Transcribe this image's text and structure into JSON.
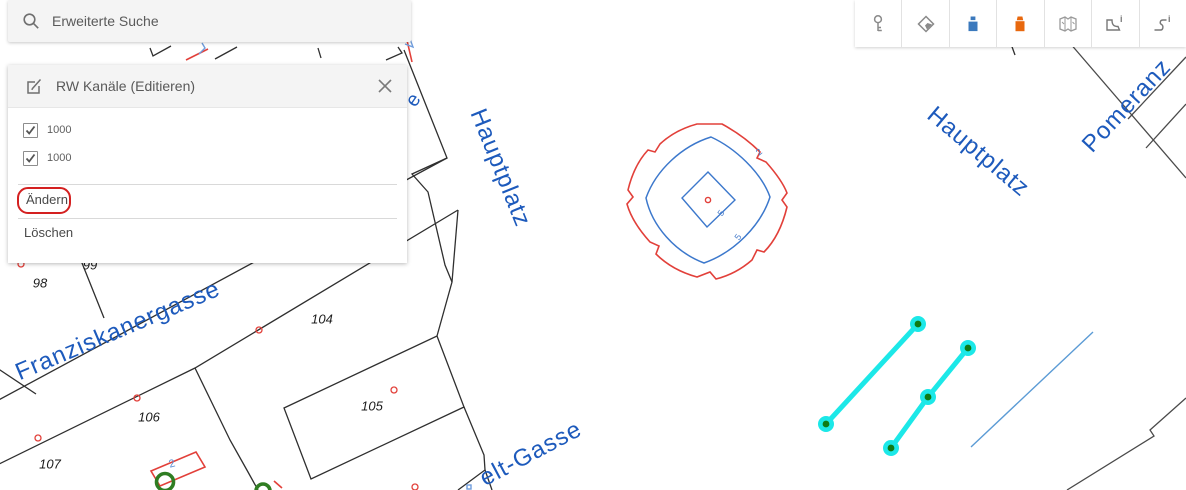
{
  "search": {
    "placeholder": "Erweiterte Suche"
  },
  "edit_panel": {
    "title": "RW Kanäle (Editieren)",
    "items": [
      {
        "type": "checkbox",
        "label": "1000",
        "checked": true
      },
      {
        "type": "checkbox",
        "label": "1000",
        "checked": true
      },
      {
        "type": "action",
        "label": "Ändern",
        "highlighted": true,
        "highlight_color": "#d42020"
      },
      {
        "type": "action",
        "label": "Löschen",
        "highlighted": false
      }
    ]
  },
  "toolbar": {
    "icons": [
      {
        "name": "key"
      },
      {
        "name": "basemap"
      },
      {
        "name": "symbol-blue",
        "color": "#3b79bd"
      },
      {
        "name": "symbol-orange",
        "color": "#e8680e"
      },
      {
        "name": "legend-map"
      },
      {
        "name": "polygon-info",
        "info_glyph": "i"
      },
      {
        "name": "line-info",
        "info_glyph": "i"
      }
    ]
  },
  "map": {
    "street_labels": [
      {
        "text": "Hauptplatz"
      },
      {
        "text": "Hauptplatz"
      },
      {
        "text": "Pomeranz"
      },
      {
        "text": "Franziskanergasse"
      },
      {
        "text": "elt-Gasse"
      },
      {
        "text": "e"
      }
    ],
    "parcel_labels": [
      {
        "text": "98"
      },
      {
        "text": "99"
      },
      {
        "text": "104"
      },
      {
        "text": "105"
      },
      {
        "text": "106"
      },
      {
        "text": "107"
      }
    ],
    "contour_labels": [
      {
        "text": "2"
      },
      {
        "text": "5"
      },
      {
        "text": "5"
      }
    ],
    "annotation_labels": [
      {
        "text": "2"
      }
    ],
    "colors": {
      "street_label_blue": "#1d5abc",
      "contour_red": "#e2403a",
      "contour_blue": "#3c78cc",
      "selection_cyan": "#1ce8e8",
      "vertex_green": "#0f7a15",
      "feature_green": "#2f7d22",
      "parcel_line": "#2f2f2f"
    }
  }
}
